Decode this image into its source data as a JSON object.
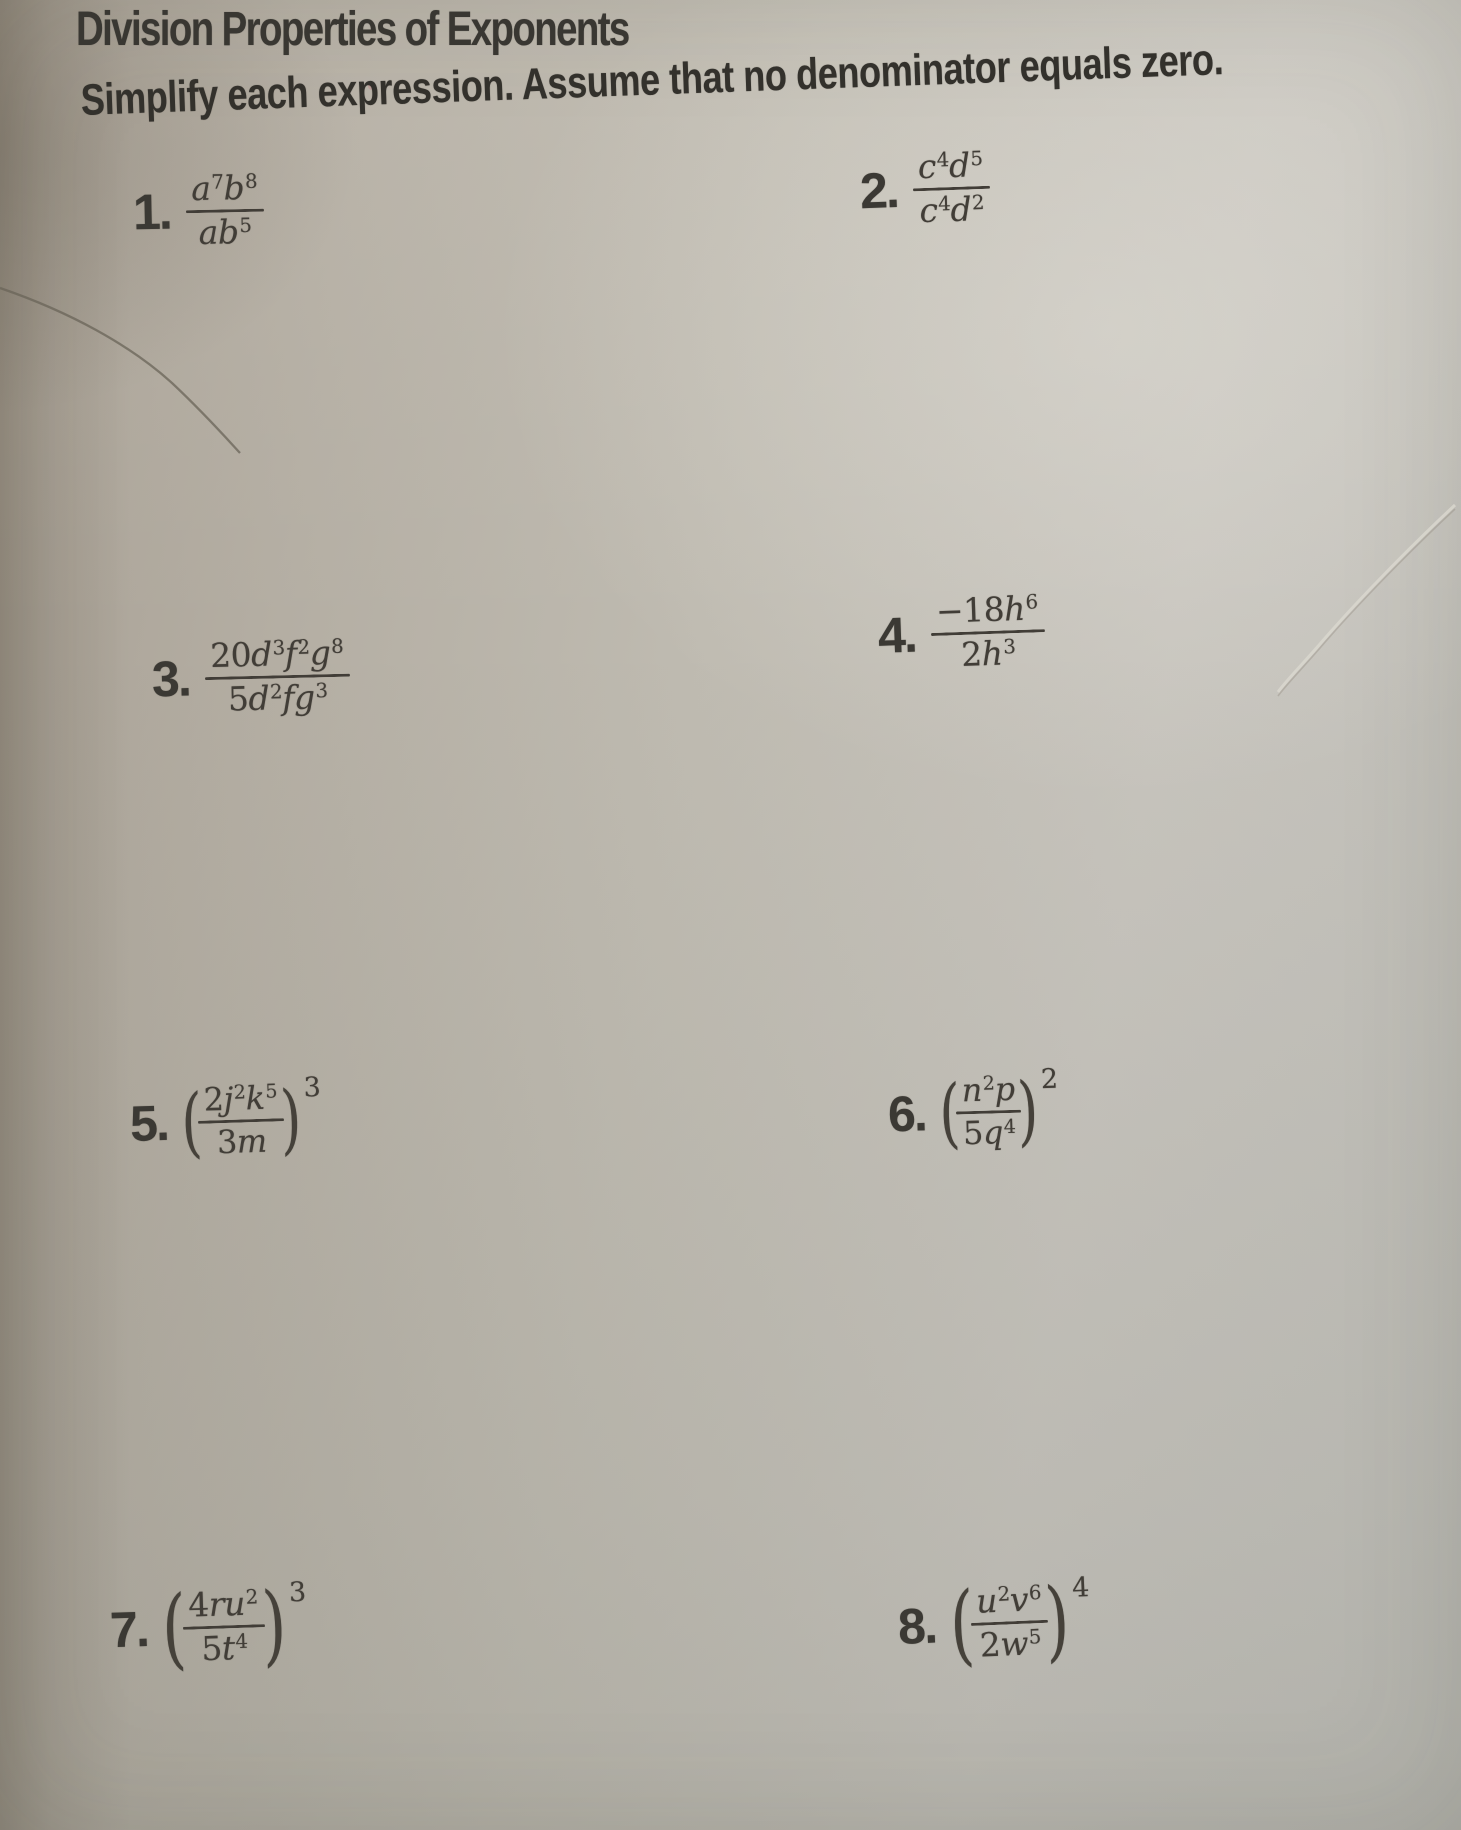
{
  "page": {
    "title": "Division Properties of Exponents",
    "instructions": "Simplify each expression. Assume that no denominator equals zero."
  },
  "ink_color": "#403c36",
  "paper_color": "#bdb9b0",
  "symbols": {
    "open_paren": "(",
    "close_paren": ")"
  },
  "problems": [
    {
      "label": "1.",
      "numerator": "a^7b^8",
      "denominator": "ab^5",
      "outer_exponent": ""
    },
    {
      "label": "2.",
      "numerator": "c^4d^5",
      "denominator": "c^4d^2",
      "outer_exponent": ""
    },
    {
      "label": "3.",
      "numerator": "20d^3f^2g^8",
      "denominator": "5d^2fg^3",
      "outer_exponent": ""
    },
    {
      "label": "4.",
      "numerator": "-18h^6",
      "denominator": "2h^3",
      "outer_exponent": ""
    },
    {
      "label": "5.",
      "numerator": "2j^2k^5",
      "denominator": "3m",
      "outer_exponent": "3"
    },
    {
      "label": "6.",
      "numerator": "n^2p",
      "denominator": "5q^4",
      "outer_exponent": "2"
    },
    {
      "label": "7.",
      "numerator": "4ru^2",
      "denominator": "5t^4",
      "outer_exponent": "3"
    },
    {
      "label": "8.",
      "numerator": "u^2v^6",
      "denominator": "2w^5",
      "outer_exponent": "4"
    }
  ]
}
